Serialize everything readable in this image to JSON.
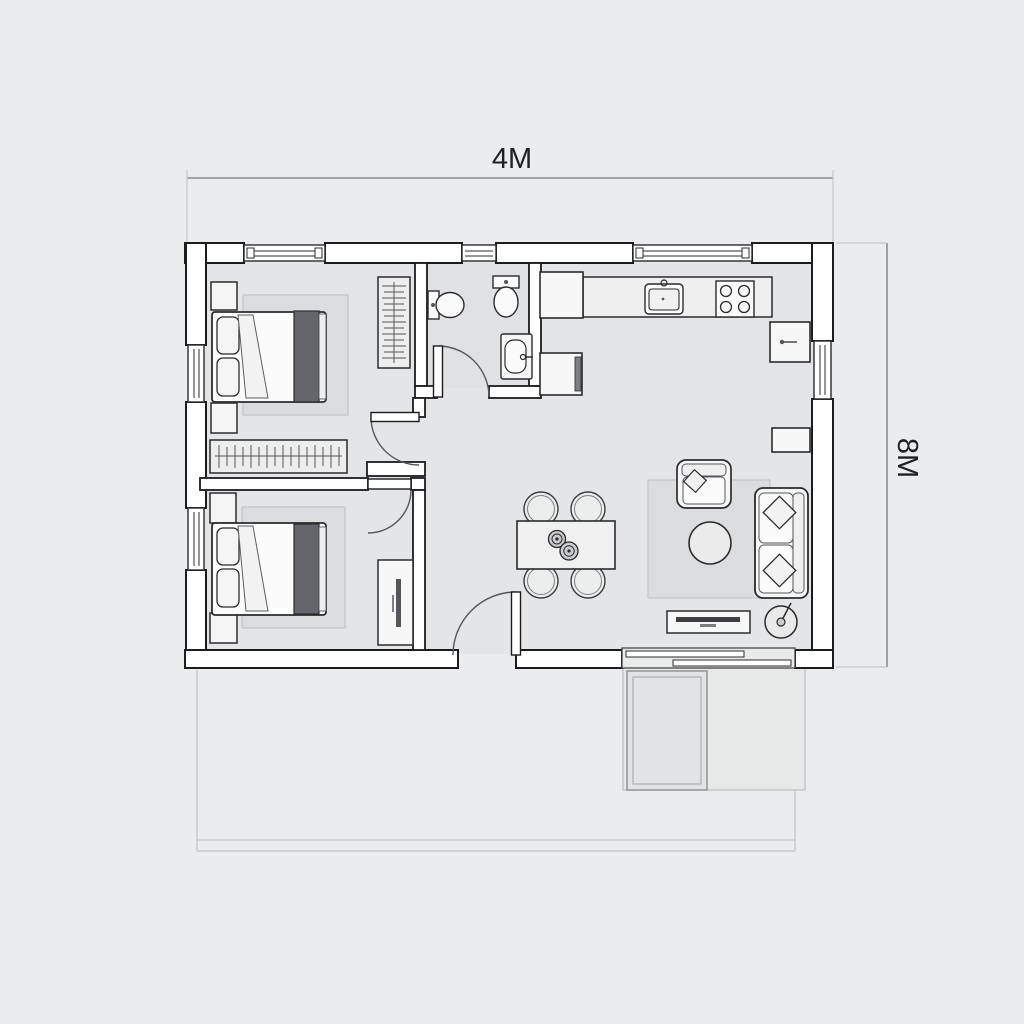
{
  "page": {
    "background_color": "#ebeced",
    "type": "architectural-floor-plan"
  },
  "dimensions": {
    "width_label": "4M",
    "height_label": "8M"
  },
  "colors": {
    "floor": "#e4e5e7",
    "bathroom_floor": "#dfe1e3",
    "wall_fill": "#ffffff",
    "wall_stroke": "#1c1c1e",
    "furniture_fill": "#f7f7f8",
    "furniture_stroke": "#2b2b2d",
    "rug": "#dbdcdd",
    "blanket": "#64666b",
    "dimension_line": "#8c8c8e",
    "dimension_text": "#202022",
    "faint_outline": "#bcbdbe"
  },
  "icons": [
    "double-bed-icon",
    "pillow-icon",
    "nightstand-icon",
    "wardrobe-rail-icon",
    "closet-rail-icon",
    "desk-icon",
    "toilet-icon",
    "washbasin-icon",
    "kitchen-sink-icon",
    "stove-burner-icon",
    "fridge-icon",
    "oven-icon",
    "dining-table-icon",
    "chair-icon",
    "plate-icon",
    "armchair-icon",
    "sofa-icon",
    "coffee-table-icon",
    "tv-stand-icon",
    "floor-lamp-icon",
    "door-swing-icon",
    "sliding-door-icon",
    "window-icon",
    "terrace-slab-icon"
  ]
}
